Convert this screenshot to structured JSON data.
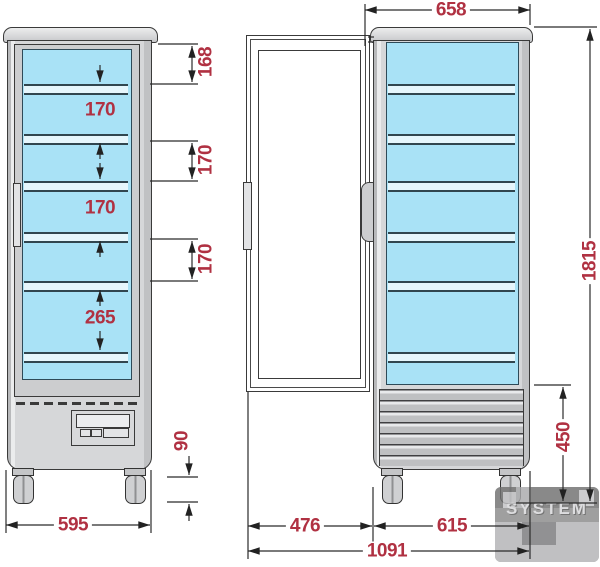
{
  "drawing": {
    "description": "refrigerated display cabinet technical drawing, front view and side view with open door",
    "units": "mm"
  },
  "dims": {
    "d168": "168",
    "d170_gap1": "170",
    "d170_ext1": "170",
    "d170_gap2": "170",
    "d170_ext2": "170",
    "d265": "265",
    "d90": "90",
    "d595": "595",
    "d658": "658",
    "d1815": "1815",
    "d450": "450",
    "d476": "476",
    "d615": "615",
    "d1091": "1091"
  },
  "watermark": {
    "text": "SYSTEM"
  },
  "colors": {
    "dimension_text": "#b03142",
    "glass_blue": "#a9e2f6",
    "body_gray": "#d6d7d9",
    "line": "#2b2b2b"
  }
}
